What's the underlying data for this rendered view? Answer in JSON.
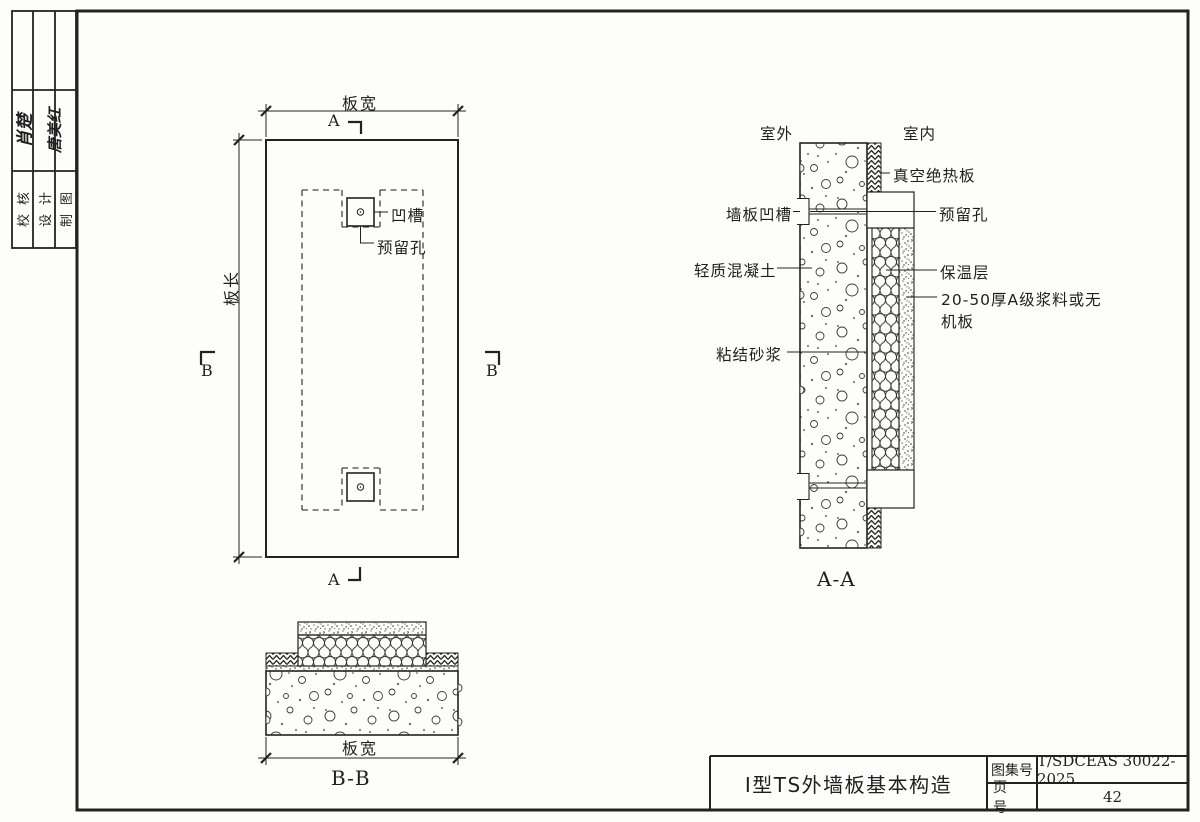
{
  "page": {
    "background": "#fdfdfc",
    "ink": "#222222"
  },
  "stamp_table": {
    "rows": [
      {
        "label": "校核",
        "signature": "肖楚"
      },
      {
        "label": "设计",
        "signature": "唐美红"
      },
      {
        "label": "制图",
        "signature": ""
      }
    ]
  },
  "plan_view": {
    "dim_width": "板宽",
    "dim_length": "板长",
    "section_mark_a": "A",
    "section_mark_b": "B",
    "labels": {
      "groove": "凹槽",
      "reserved_hole": "预留孔"
    }
  },
  "section_aa": {
    "title": "A-A",
    "outside": "室外",
    "inside": "室内",
    "labels": {
      "vacuum_panel": "真空绝热板",
      "panel_groove": "墙板凹槽",
      "reserved_hole": "预留孔",
      "lightweight_concrete": "轻质混凝土",
      "insulation_layer": "保温层",
      "mortar_board_line1": "20-50厚A级浆料或无",
      "mortar_board_line2": "机板",
      "bond_mortar": "粘结砂浆"
    }
  },
  "section_bb": {
    "title": "B-B",
    "dim_width": "板宽"
  },
  "title_block": {
    "drawing_title": "I型TS外墙板基本构造",
    "atlas_no_label": "图集号",
    "atlas_no_value": "T/SDCEAS 30022-2025",
    "page_no_label": "页 号",
    "page_no_value": "42"
  }
}
